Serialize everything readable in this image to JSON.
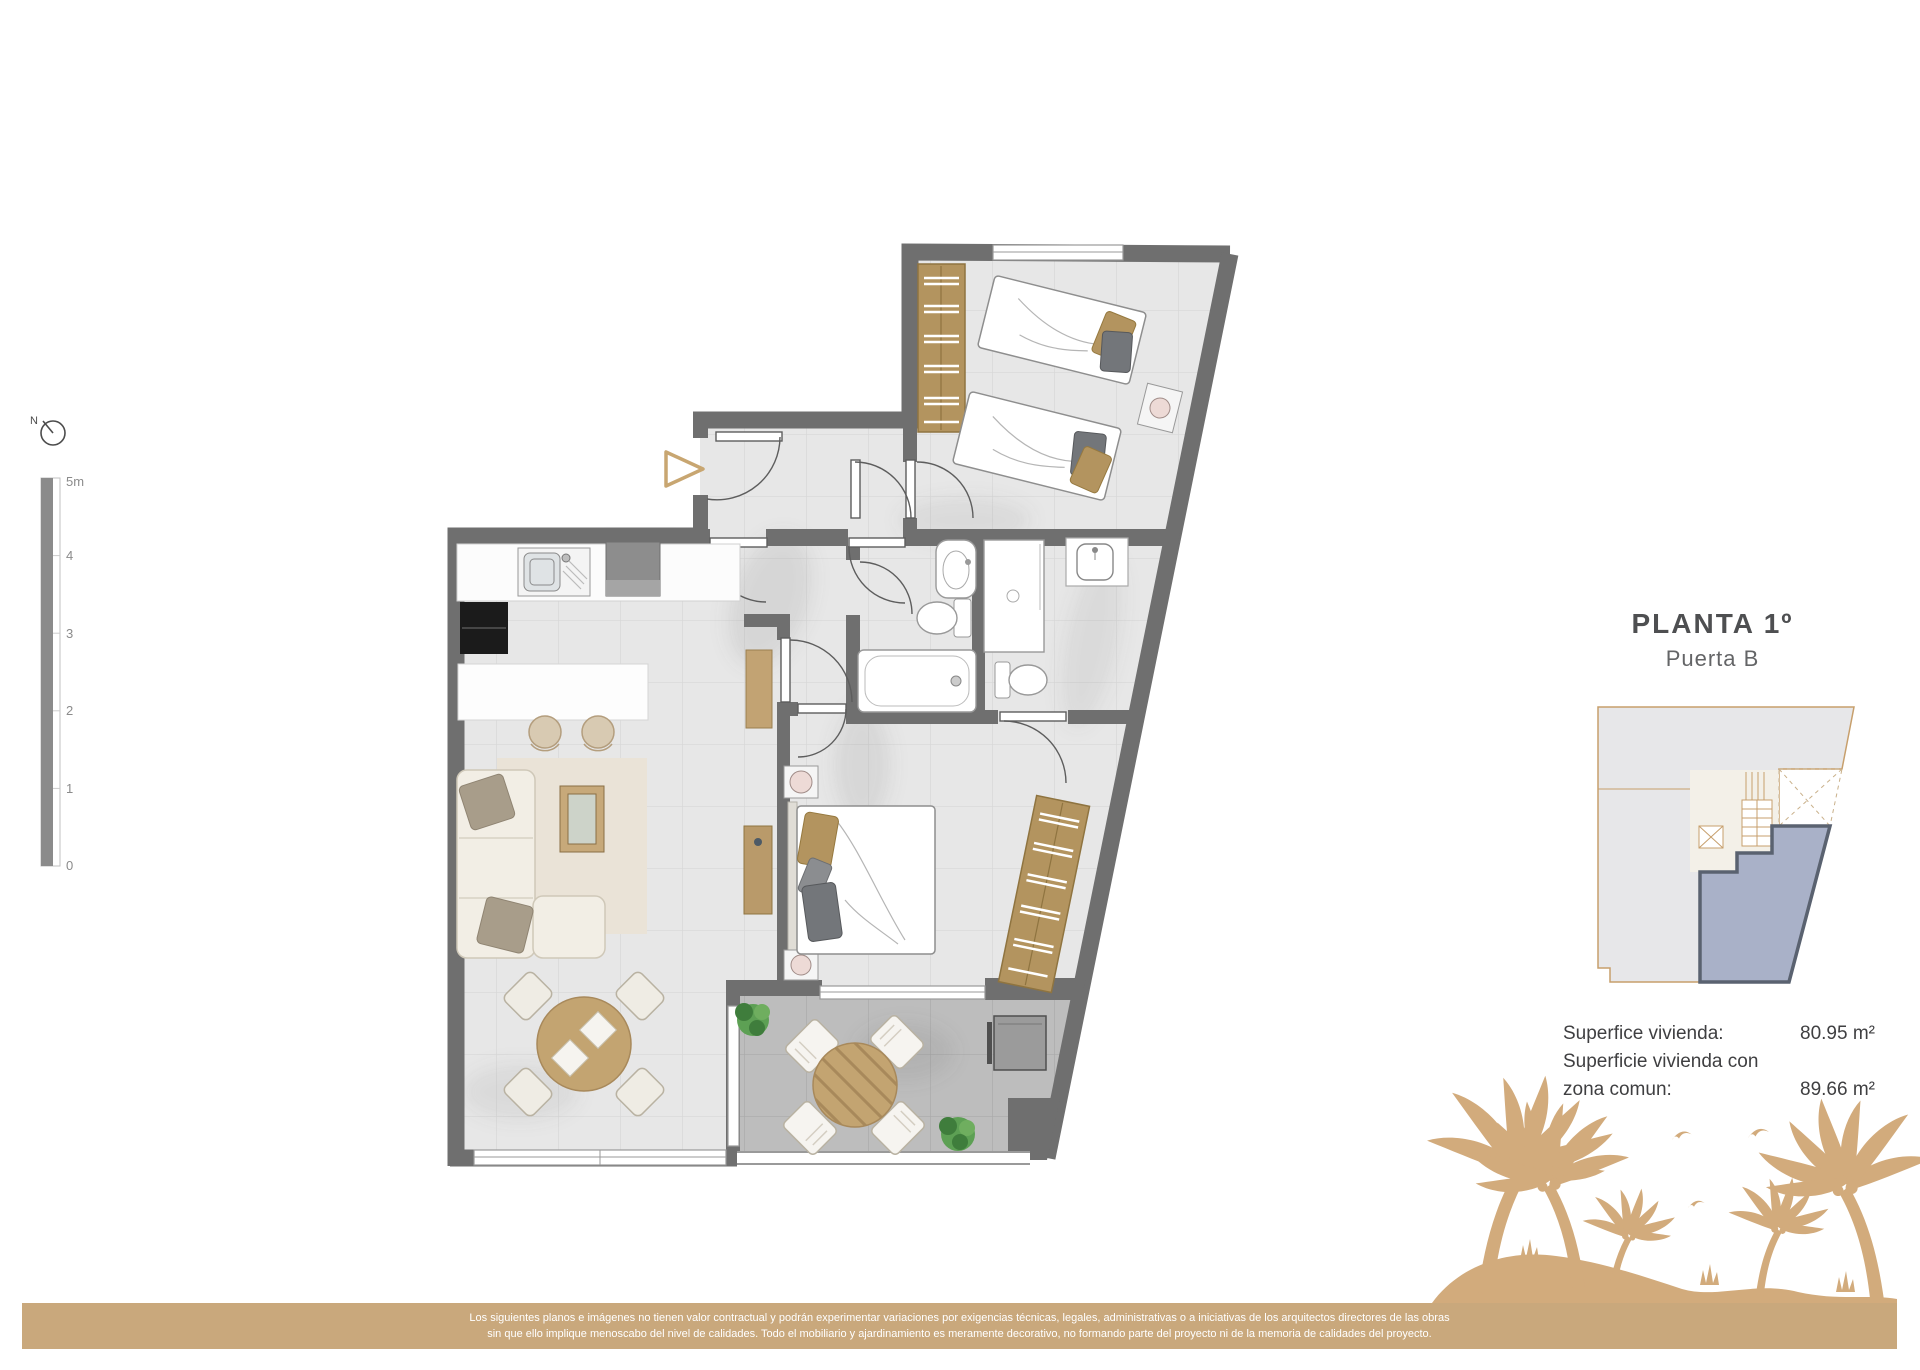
{
  "title": {
    "floor": "PLANTA 1º",
    "door": "Puerta B"
  },
  "areas": {
    "rows": [
      {
        "label": "Superfice vivienda:",
        "value": "80.95 m²"
      },
      {
        "label": "Superficie vivienda con",
        "value": ""
      },
      {
        "label": "zona comun:",
        "value": "89.66 m²"
      }
    ]
  },
  "scale_bar": {
    "labels": [
      "5m",
      "4",
      "3",
      "2",
      "1",
      "0"
    ]
  },
  "compass": {
    "label": "N"
  },
  "footer": {
    "line1": "Los siguientes planos e imágenes no tienen valor contractual y podrán experimentar variaciones por exigencias técnicas, legales, administrativas o a iniciativas de los arquitectos directores de las obras",
    "line2": "sin que ello implique menoscabo del nivel de calidades. Todo el mobiliario y ajardinamiento es meramente decorativo, no formando parte del proyecto ni de la memoria de calidades del proyecto."
  },
  "colors": {
    "accent_tan": "#c9a87c",
    "palm_tan": "#d2ab7c",
    "wall_gray": "#6f6f6f",
    "floor_gray": "#e7e7e7",
    "terrace_gray": "#bdbdbd",
    "wood": "#b3945f",
    "unit_highlight_fill": "#a9b1c8",
    "unit_highlight_stroke": "#5a6270",
    "minimap_outline": "#c79f6c",
    "footer_text": "#ffffff"
  }
}
